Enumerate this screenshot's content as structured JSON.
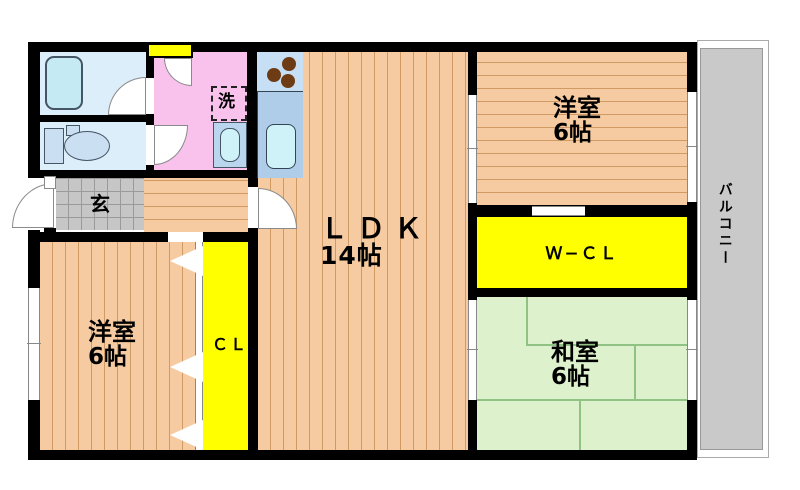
{
  "floorplan": {
    "rooms": {
      "ldk": {
        "label": "ＬＤＫ",
        "size": "14帖"
      },
      "western_room_top": {
        "label": "洋室",
        "size": "6帖"
      },
      "western_room_left": {
        "label": "洋室",
        "size": "6帖"
      },
      "japanese_room": {
        "label": "和室",
        "size": "6帖"
      },
      "walk_in_closet": {
        "label": "Ｗ−ＣＬ"
      },
      "closet": {
        "label": "ＣＬ"
      },
      "entrance": {
        "label": "玄"
      },
      "laundry": {
        "label": "洗"
      },
      "balcony": {
        "label": "バルコニー"
      }
    },
    "colors": {
      "wall": "#000000",
      "wood_floor": "#F6CBA1",
      "tatami": "#DDF2CC",
      "closet_yellow": "#FFFF00",
      "washroom_pink": "#F8C2EC",
      "bath_blue": "#DCEEF9",
      "kitchen_blue": "#AFCDE9",
      "balcony_gray": "#C9C9C9"
    }
  }
}
